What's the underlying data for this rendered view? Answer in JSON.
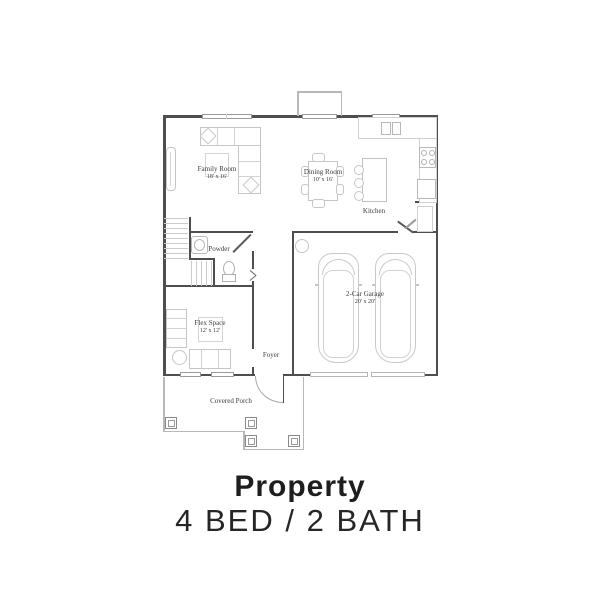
{
  "caption": {
    "title": "Property",
    "subtitle": "4 BED / 2 BATH"
  },
  "floorplan": {
    "family_room": {
      "name": "Family Room",
      "dims": "18' x 16'"
    },
    "dining_room": {
      "name": "Dining Room",
      "dims": "10' x 16'"
    },
    "kitchen": {
      "name": "Kitchen"
    },
    "powder": {
      "name": "Powder"
    },
    "flex_space": {
      "name": "Flex Space",
      "dims": "12' x 12'"
    },
    "foyer": {
      "name": "Foyer"
    },
    "garage": {
      "name": "2-Car Garage",
      "dims": "20' x 20'"
    },
    "covered_porch": {
      "name": "Covered Porch"
    },
    "colors": {
      "wall": "#4e4e4e",
      "furniture_line": "#c6c6c6",
      "window_line": "#9a9a9a",
      "porch_line": "#b8b8b8",
      "label_text": "#3c3c3c",
      "heading_text": "#1e1e1e"
    }
  }
}
